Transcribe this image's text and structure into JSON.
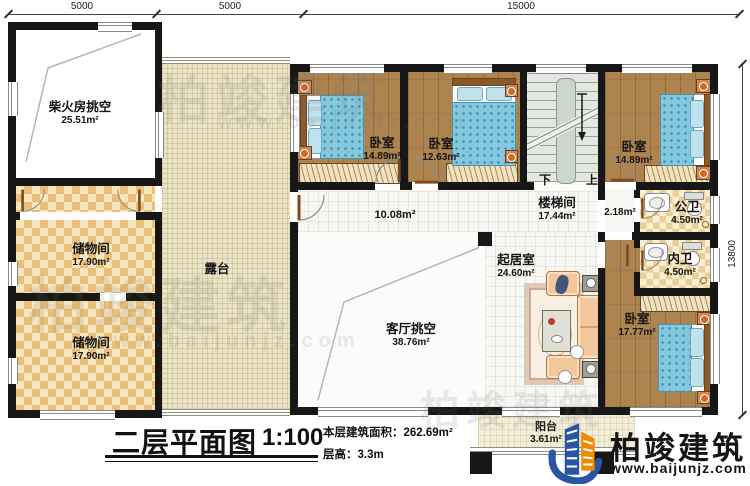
{
  "dims": {
    "top": [
      "5000",
      "5000",
      "15000"
    ],
    "right": "13800"
  },
  "rooms": {
    "chaihuofang": {
      "label": "柴火房挑空",
      "area": "25.51m²"
    },
    "chuwu1": {
      "label": "储物间",
      "area": "17.90m²"
    },
    "chuwu2": {
      "label": "储物间",
      "area": "17.90m²"
    },
    "lutai": {
      "label": "露台"
    },
    "bedroom1": {
      "label": "卧室",
      "area": "14.89m²"
    },
    "bedroom2": {
      "label": "卧室",
      "area": "12.63m²"
    },
    "bedroom3": {
      "label": "卧室",
      "area": "14.89m²"
    },
    "louti": {
      "label": "楼梯间",
      "area": "17.44m²"
    },
    "corridor": {
      "area": "10.08m²"
    },
    "hall": {
      "area": "2.18m²"
    },
    "gongwei": {
      "label": "公卫",
      "area": "4.50m²"
    },
    "neiwei": {
      "label": "内卫",
      "area": "4.50m²"
    },
    "bedroom4": {
      "label": "卧室",
      "area": "17.77m²"
    },
    "qijushi": {
      "label": "起居室",
      "area": "24.60m²"
    },
    "keting": {
      "label": "客厅挑空",
      "area": "38.76m²"
    },
    "yangtai": {
      "label": "阳台",
      "area": "3.61m²"
    }
  },
  "stairs": {
    "down": "下",
    "up": "上"
  },
  "titleblock": {
    "title": "二层平面图",
    "scale": "1:100",
    "area_label": "本层建筑面积：",
    "area_value": "262.69m²",
    "height_label": "层高：",
    "height_value": "3.3m"
  },
  "logo": {
    "name": "柏竣建筑",
    "website": "www.baijunjz.com"
  },
  "watermark": {
    "text": "柏竣建筑",
    "url": "www.baijunjz.com"
  }
}
